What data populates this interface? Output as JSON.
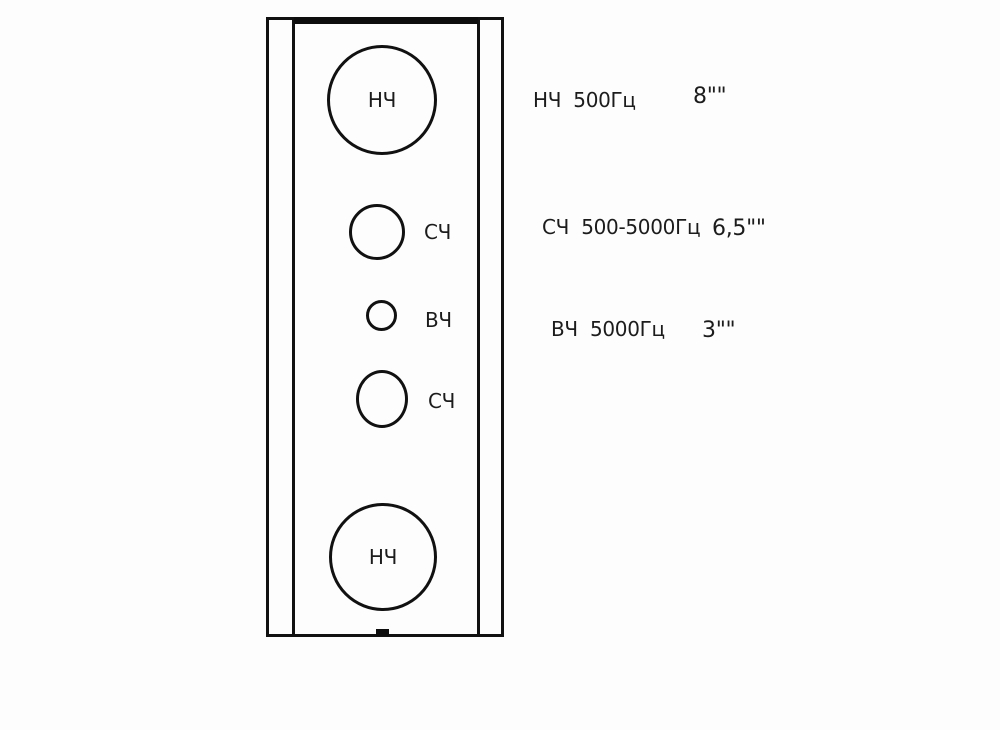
{
  "colors": {
    "background": "#fdfdfd",
    "line": "#111111",
    "text": "#1c1c1c"
  },
  "diagram": {
    "type": "speaker-cabinet-front-layout",
    "drivers": {
      "woofer_top": {
        "label": "НЧ"
      },
      "mid_upper": {
        "label": "СЧ"
      },
      "tweeter": {
        "label": "ВЧ"
      },
      "mid_lower": {
        "label": "СЧ"
      },
      "woofer_bottom": {
        "label": "НЧ"
      }
    }
  },
  "annotations": [
    {
      "label": "НЧ  500Гц",
      "size": "8\"\""
    },
    {
      "label": "СЧ  500-5000Гц",
      "size": "6,5\"\""
    },
    {
      "label": "ВЧ  5000Гц",
      "size": "3\"\""
    }
  ]
}
